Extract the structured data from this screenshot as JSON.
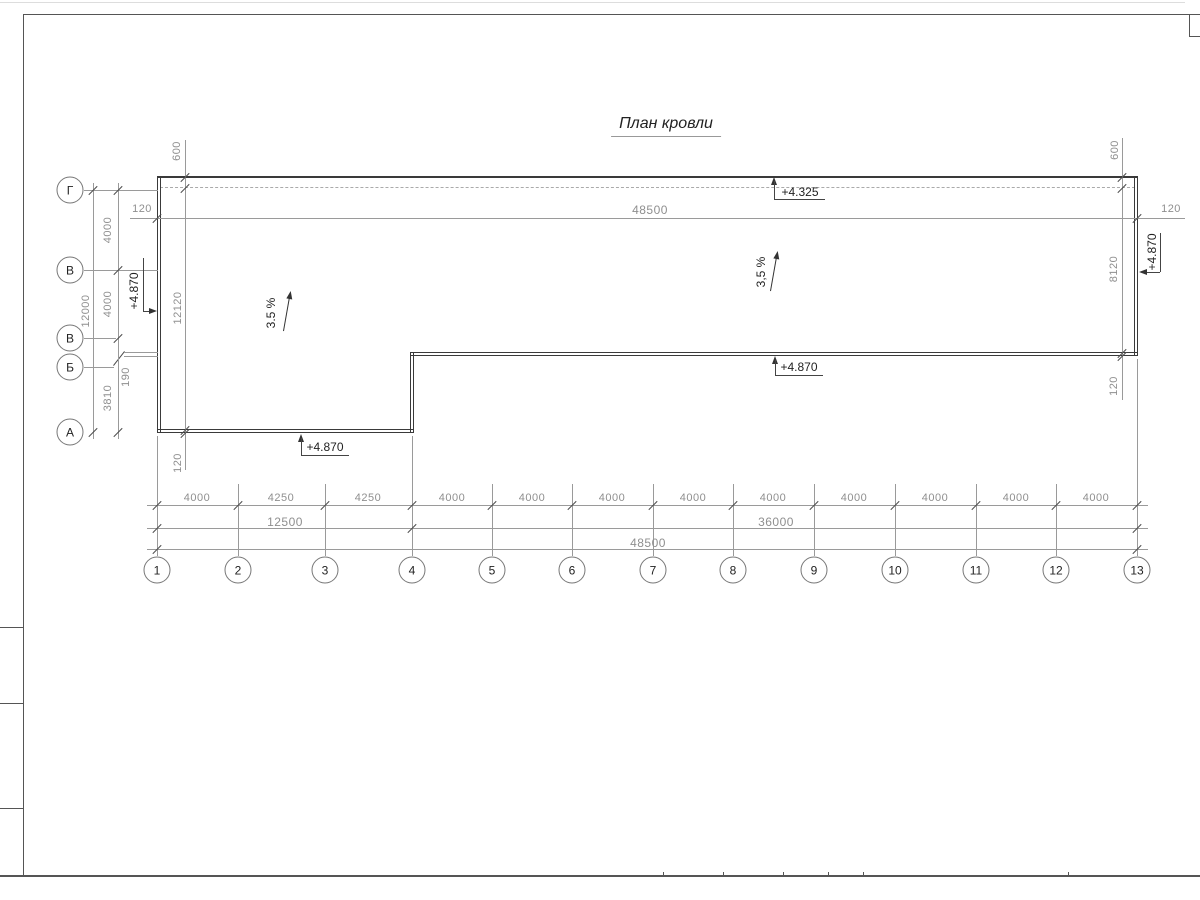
{
  "title": {
    "text": "План кровли"
  },
  "colors": {
    "wall_line": "#3a3a3a",
    "dim_line": "#9a9a9a",
    "dim_text": "#8f8f8f",
    "dark_text": "#222222",
    "frame": "#555555"
  },
  "axes": {
    "row_labels": [
      "Г",
      "В",
      "В",
      "Б",
      "А"
    ],
    "col_labels": [
      "1",
      "2",
      "3",
      "4",
      "5",
      "6",
      "7",
      "8",
      "9",
      "10",
      "11",
      "12",
      "13"
    ]
  },
  "dimensions": {
    "top": {
      "total": "48500",
      "left_offset": "120",
      "right_offset": "120"
    },
    "left": {
      "overhang": "600",
      "overall": "12120",
      "total": "12000",
      "seg1": "4000",
      "seg2": "4000",
      "seg3": "190",
      "seg4": "3810",
      "parapet": "120"
    },
    "right": {
      "overhang": "600",
      "height": "8120",
      "offset": "120",
      "parapet": "120"
    },
    "bottom": {
      "bays": [
        "4000",
        "4250",
        "4250",
        "4000",
        "4000",
        "4000",
        "4000",
        "4000",
        "4000",
        "4000",
        "4000",
        "4000"
      ],
      "group_left": "12500",
      "group_right": "36000",
      "total": "48500"
    }
  },
  "elevations": {
    "top": "+4.325",
    "left_wall": "+4.870",
    "right_wall": "+4.870",
    "step_bottom": "+4.870",
    "left_bottom": "+4.870"
  },
  "slopes": {
    "left": "3.5 %",
    "right": "3,5 %"
  }
}
